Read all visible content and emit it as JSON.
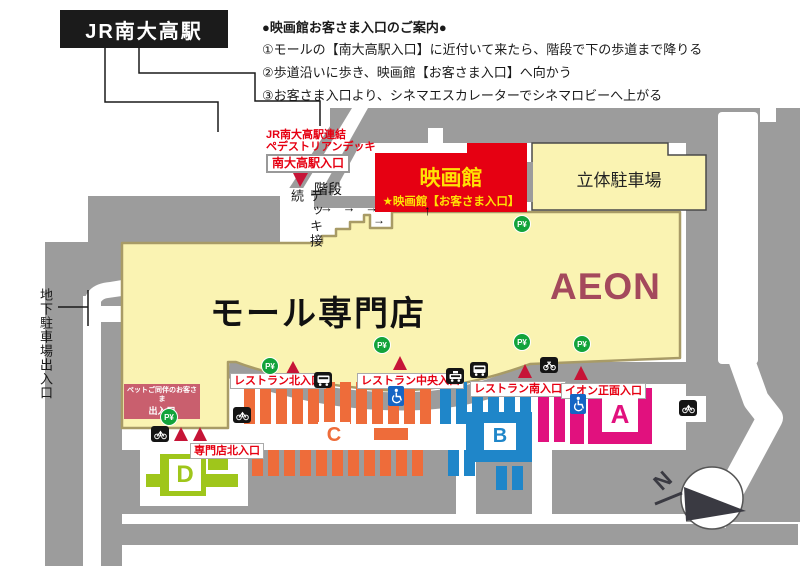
{
  "station": {
    "label": "JR南大高駅"
  },
  "guide": {
    "title": "●映画館お客さま入口のご案内●",
    "step1": "①モールの【南大高駅入口】に近付いて来たら、階段で下の歩道まで降りる",
    "step2": "②歩道沿いに歩き、映画館【お客さま入口】へ向かう",
    "step3": "③お客さま入口より、シネマエスカレーターでシネマロビーへ上がる"
  },
  "deck": {
    "line1": "JR南大高駅連結",
    "line2": "ペデストリアンデッキ",
    "station_entrance": "南大高駅入口",
    "stairs": "階段",
    "connection": "デッキ接続",
    "walk_arrows": "→ → →",
    "notch_arrow": "→",
    "up_arrow": "↑"
  },
  "buildings": {
    "mall": "モール専門店",
    "aeon": "AEON",
    "cinema": "映画館",
    "cinema_entrance": "★映画館【お客さま入口】",
    "garage": "立体駐車場"
  },
  "entrances": {
    "restaurant_north": "レストラン北入口",
    "restaurant_central": "レストラン中央入口",
    "restaurant_south": "レストラン南入口",
    "aeon_front": "イオン正面入口",
    "specialty_north": "専門店北入口",
    "pet_line1": "ペットご同伴のお客さま",
    "pet_line2": "出入口",
    "underground": "地下駐車場出入口"
  },
  "parking": {
    "zone_a": "A",
    "zone_b": "B",
    "zone_c": "C",
    "zone_d": "D",
    "paid_icon": "P¥"
  },
  "compass": {
    "north": "N"
  },
  "colors": {
    "cinema_red": "#e60012",
    "building_cream": "#faf3b2",
    "building_edge_olive": "#a89b66",
    "zone_a_pink": "#e1117e",
    "zone_b_blue": "#1f86c9",
    "zone_c_orange": "#ee6c3a",
    "zone_d_lime": "#9fc61b",
    "road_gray": "#9c9c9c",
    "paid_parking_green": "#12a33b",
    "triangle_red": "#c61437",
    "aeon_maroon": "#a4495c",
    "cinema_text_yellow": "#ffe104"
  }
}
